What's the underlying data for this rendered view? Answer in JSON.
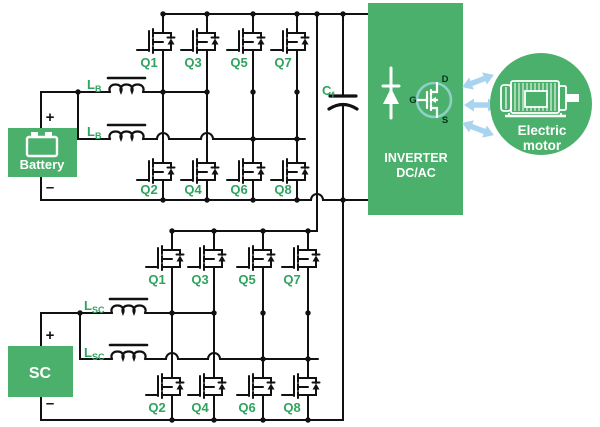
{
  "colors": {
    "block_green": "#4bb06b",
    "label_green": "#2ea45f",
    "wire_black": "#111111",
    "arrow_blue": "#a9d4ef",
    "inverter_mosfet_circle": "#8fd0c6",
    "white": "#ffffff"
  },
  "battery_block": {
    "label": "Battery",
    "plus": "+",
    "minus": "–"
  },
  "sc_block": {
    "label": "SC",
    "plus": "+",
    "minus": "–"
  },
  "battery_converter": {
    "inductors": [
      {
        "main": "L",
        "sub": "B"
      },
      {
        "main": "L",
        "sub": "B"
      }
    ],
    "upper_switches": [
      "Q1",
      "Q3",
      "Q5",
      "Q7"
    ],
    "lower_switches": [
      "Q2",
      "Q4",
      "Q6",
      "Q8"
    ]
  },
  "sc_converter": {
    "inductors": [
      {
        "main": "L",
        "sub": "SC"
      },
      {
        "main": "L",
        "sub": "SC"
      }
    ],
    "upper_switches": [
      "Q1",
      "Q3",
      "Q5",
      "Q7"
    ],
    "lower_switches": [
      "Q2",
      "Q4",
      "Q6",
      "Q8"
    ]
  },
  "dc_link_capacitor": {
    "main": "C",
    "sub": "f"
  },
  "inverter": {
    "line1": "INVERTER",
    "line2": "DC/AC",
    "pins": {
      "gate": "G",
      "drain": "D",
      "source": "S"
    }
  },
  "motor": {
    "line1": "Electric",
    "line2": "motor"
  }
}
